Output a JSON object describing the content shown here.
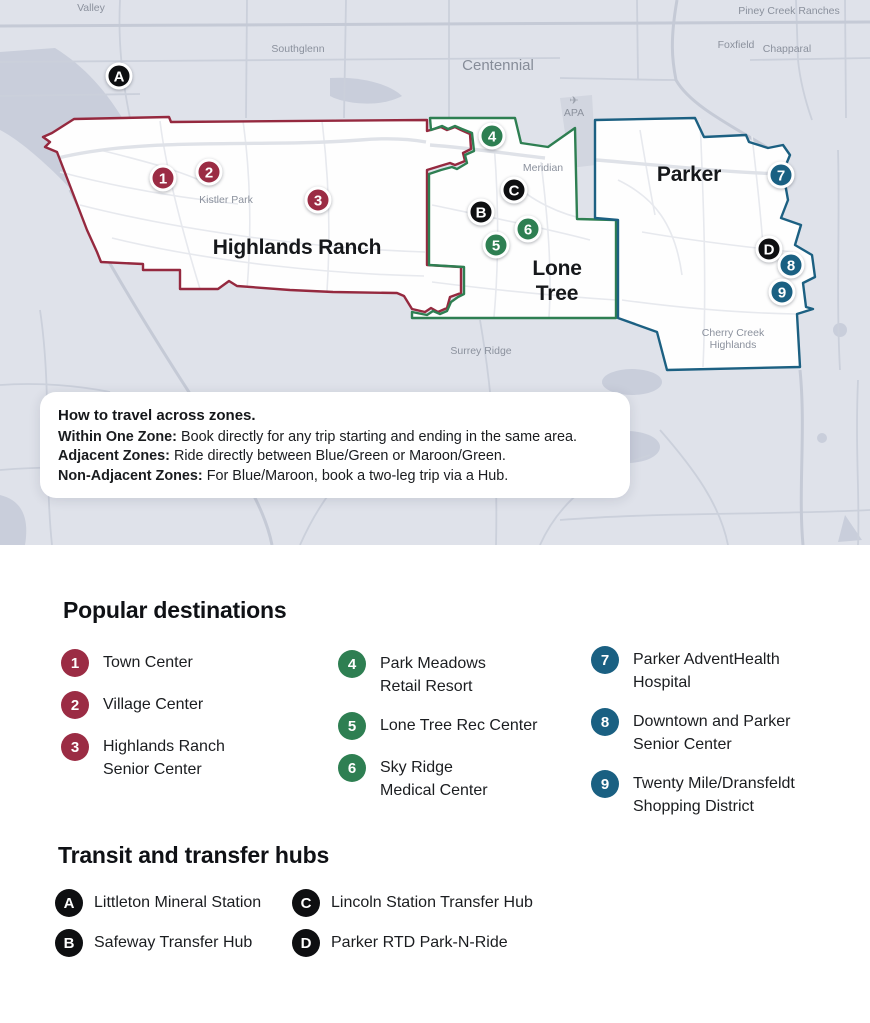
{
  "map": {
    "place_labels": [
      "Valley",
      "Southglenn",
      "Centennial",
      "Piney Creek Ranches",
      "Foxfield",
      "Chapparal",
      "Meridian",
      "Kistler Park",
      "Surrey Ridge",
      "Cherry Creek",
      "Highlands",
      "APA"
    ],
    "icons": {
      "plane": "✈"
    },
    "zones": [
      {
        "name": "Highlands Ranch",
        "color": "#95293f",
        "label_lines": [
          "Highlands Ranch"
        ]
      },
      {
        "name": "Lone Tree",
        "color": "#2e7f52",
        "label_lines": [
          "Lone",
          "Tree"
        ]
      },
      {
        "name": "Parker",
        "color": "#1c6082",
        "label_lines": [
          "Parker"
        ]
      }
    ],
    "info_box": {
      "title": "How to travel across zones.",
      "lines": [
        {
          "bold": "Within One Zone:",
          "rest": " Book directly for any trip starting and ending in the same area."
        },
        {
          "bold": "Adjacent Zones:",
          "rest": " Ride directly between Blue/Green or Maroon/Green."
        },
        {
          "bold": "Non-Adjacent Zones:",
          "rest": " For Blue/Maroon, book a two-leg trip via a Hub."
        }
      ]
    }
  },
  "legend": {
    "destinations_title": "Popular destinations",
    "destinations": [
      {
        "num": "1",
        "label": "Town Center"
      },
      {
        "num": "2",
        "label": "Village Center"
      },
      {
        "num": "3",
        "label": "Highlands Ranch\nSenior Center"
      },
      {
        "num": "4",
        "label": "Park Meadows\nRetail Resort"
      },
      {
        "num": "5",
        "label": "Lone Tree Rec Center"
      },
      {
        "num": "6",
        "label": "Sky Ridge\nMedical Center"
      },
      {
        "num": "7",
        "label": "Parker AdventHealth\nHospital"
      },
      {
        "num": "8",
        "label": "Downtown and Parker\nSenior Center"
      },
      {
        "num": "9",
        "label": "Twenty Mile/Dransfeldt\nShopping District"
      }
    ],
    "hubs_title": "Transit and transfer hubs",
    "hubs": [
      {
        "letter": "A",
        "label": "Littleton Mineral Station"
      },
      {
        "letter": "B",
        "label": "Safeway Transfer Hub"
      },
      {
        "letter": "C",
        "label": "Lincoln Station Transfer Hub"
      },
      {
        "letter": "D",
        "label": "Parker RTD Park-N-Ride"
      }
    ]
  },
  "colors": {
    "maroon": "#9b2c44",
    "green": "#2e7f52",
    "blue": "#1a6082",
    "hub_black": "#0e0f11",
    "map_background": "#dfe2ea",
    "zone_fill": "#fefefe"
  }
}
